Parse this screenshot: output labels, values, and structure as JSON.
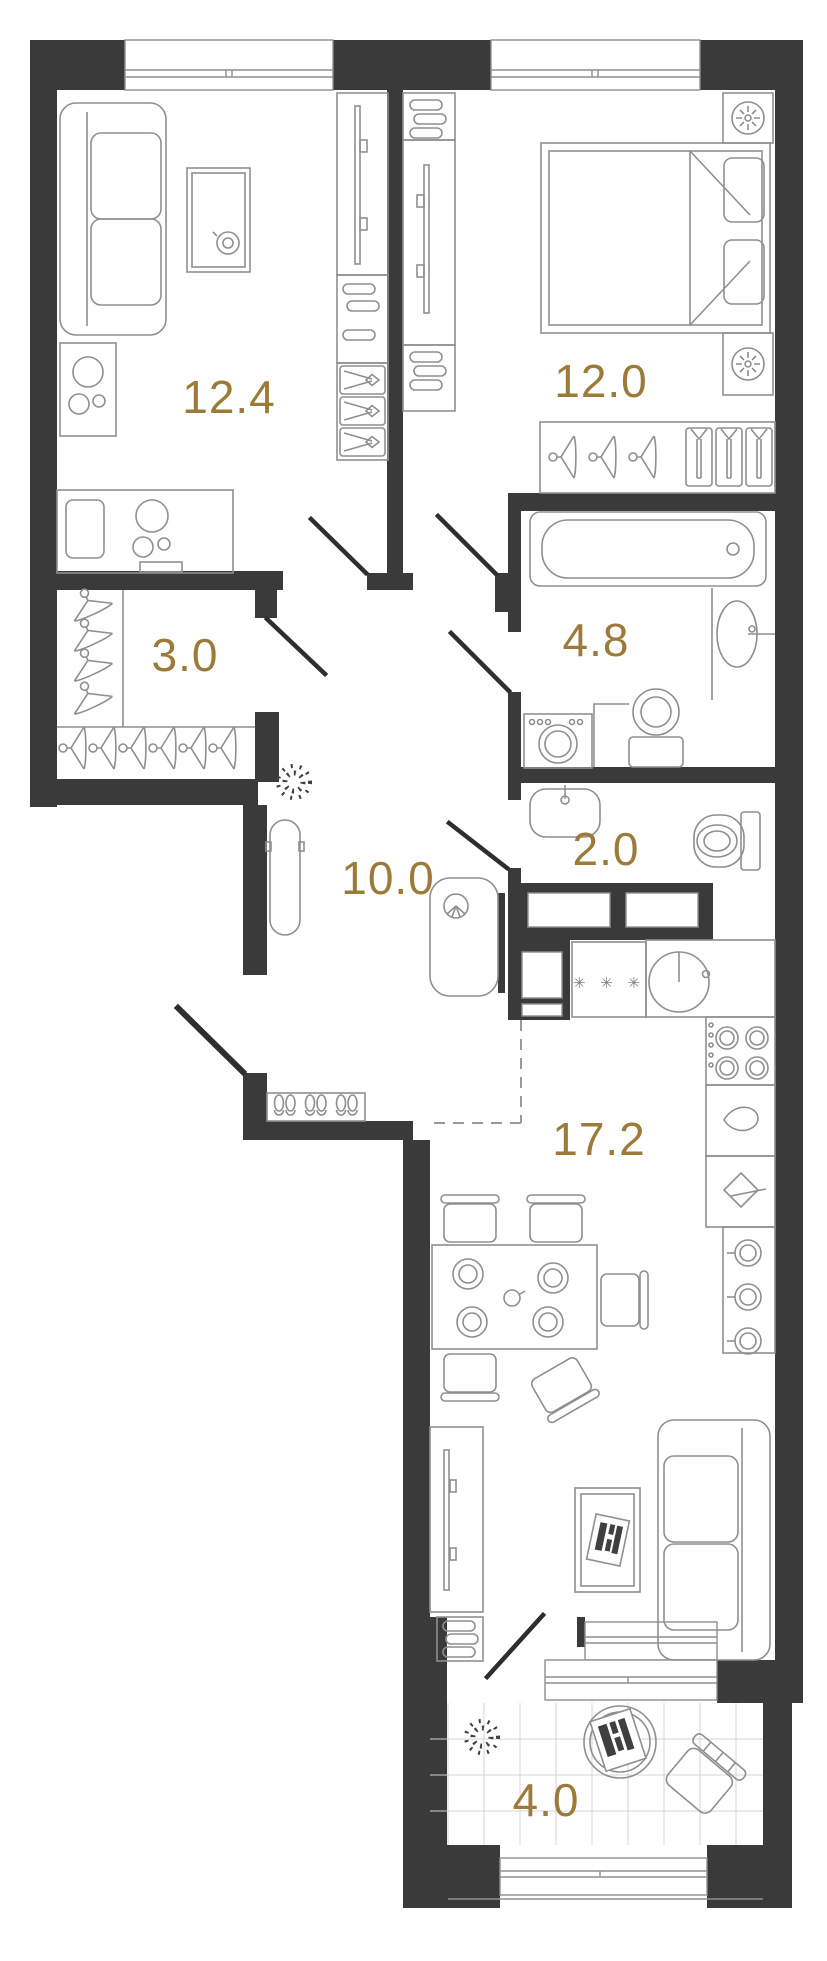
{
  "title": "Apartment floor plan",
  "colors": {
    "wall": "#3a3a3a",
    "room_label": "#9c7b3a",
    "furniture_line": "#8f8f8f",
    "door_leaf": "#2e2e2e",
    "tile_line": "#d4d4d4"
  },
  "rooms": [
    {
      "name": "living-room",
      "area_label": "12.4",
      "furniture": [
        "sofa",
        "coffee-table",
        "tv-wardrobe",
        "folded-clothes-boxes",
        "desk",
        "desk-chair",
        "plant"
      ]
    },
    {
      "name": "bedroom",
      "area_label": "12.0",
      "furniture": [
        "double-bed",
        "pillows",
        "nightstand-lamp",
        "nightstand-lamp",
        "shelving-tv",
        "wardrobe-hangers-shirts"
      ]
    },
    {
      "name": "wardrobe-room",
      "area_label": "3.0",
      "furniture": [
        "clothes-hangers"
      ]
    },
    {
      "name": "bathroom",
      "area_label": "4.8",
      "furniture": [
        "bathtub",
        "sink",
        "toilet",
        "washing-machine"
      ]
    },
    {
      "name": "wc",
      "area_label": "2.0",
      "furniture": [
        "sink",
        "toilet"
      ]
    },
    {
      "name": "hallway",
      "area_label": "10.0",
      "furniture": [
        "mirror",
        "plant",
        "shoe-shelf",
        "armchair"
      ]
    },
    {
      "name": "kitchen-living-room",
      "area_label": "17.2",
      "furniture": [
        "refrigerator",
        "kitchen-sink",
        "stove",
        "cabinets",
        "dining-table",
        "chairs",
        "tv-stand",
        "coffee-table",
        "sofa"
      ]
    },
    {
      "name": "balcony",
      "area_label": "4.0",
      "furniture": [
        "plant",
        "round-table",
        "chair"
      ]
    }
  ],
  "symbols": {
    "refrigerator_marks": "✳ ✳ ✳"
  }
}
